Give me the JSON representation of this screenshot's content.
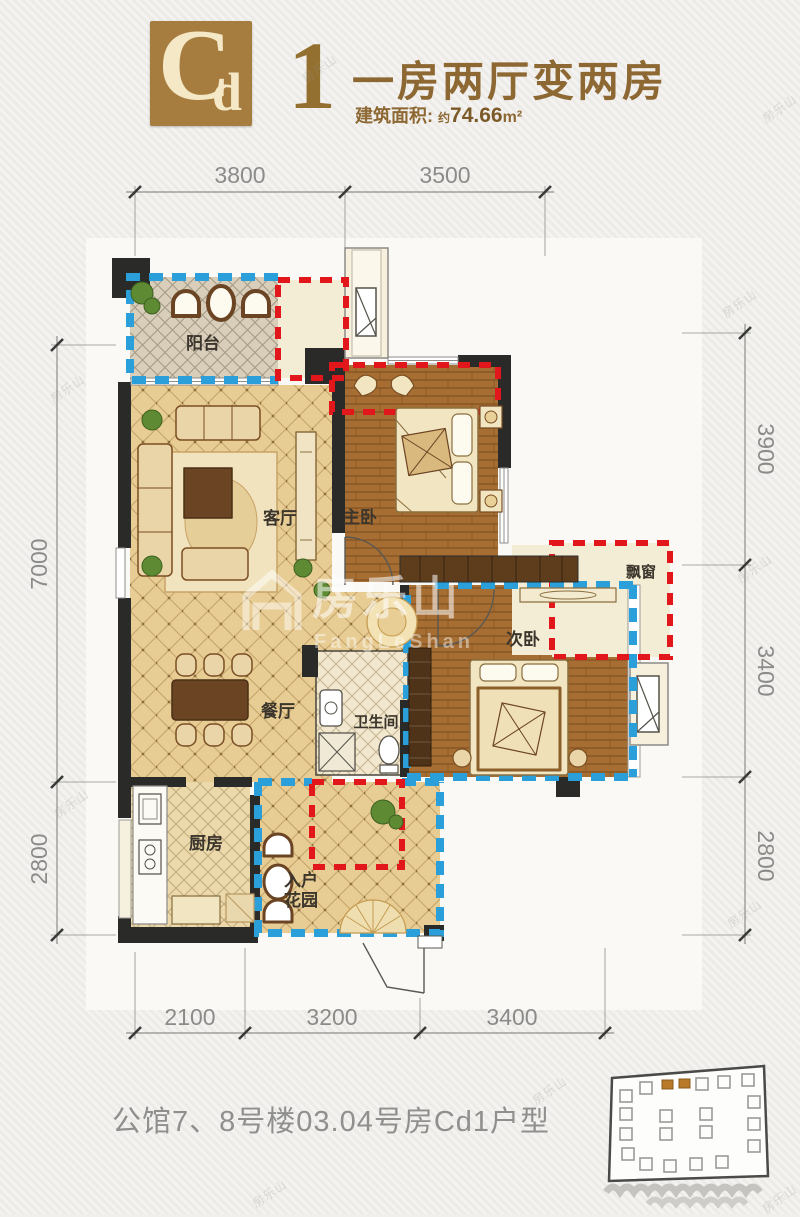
{
  "header": {
    "logo": {
      "main": "C",
      "sub": "d"
    },
    "unit": "1",
    "title": "一房两厅变两房",
    "area": {
      "label": "建筑面积:",
      "approx": "约",
      "value": "74.66",
      "unit": "m²"
    }
  },
  "rooms": {
    "balcony": "阳台",
    "living": "客厅",
    "master": "主卧",
    "bay": "飘窗",
    "second": "次卧",
    "dining": "餐厅",
    "bath": "卫生间",
    "kitchen": "厨房",
    "entry1": "入户",
    "entry2": "花园"
  },
  "dimensions": {
    "top": [
      "3800",
      "3500"
    ],
    "left": [
      "7000",
      "2800"
    ],
    "right": [
      "3900",
      "3400",
      "2800"
    ],
    "bottom": [
      "2100",
      "3200",
      "3400"
    ]
  },
  "footer": {
    "caption": "公馆7、8号楼03.04号房Cd1户型"
  },
  "watermark": {
    "brand": "房乐山",
    "latin": "FangLeShan"
  },
  "colors": {
    "accent_blue": "#2B9FD9",
    "accent_red": "#E2171B",
    "header_brown": "#A67C3F",
    "title_brown": "#8D6832",
    "wall": "#2A2A28",
    "floor_tan": "#E8CD94",
    "wood": "#A66E33"
  }
}
